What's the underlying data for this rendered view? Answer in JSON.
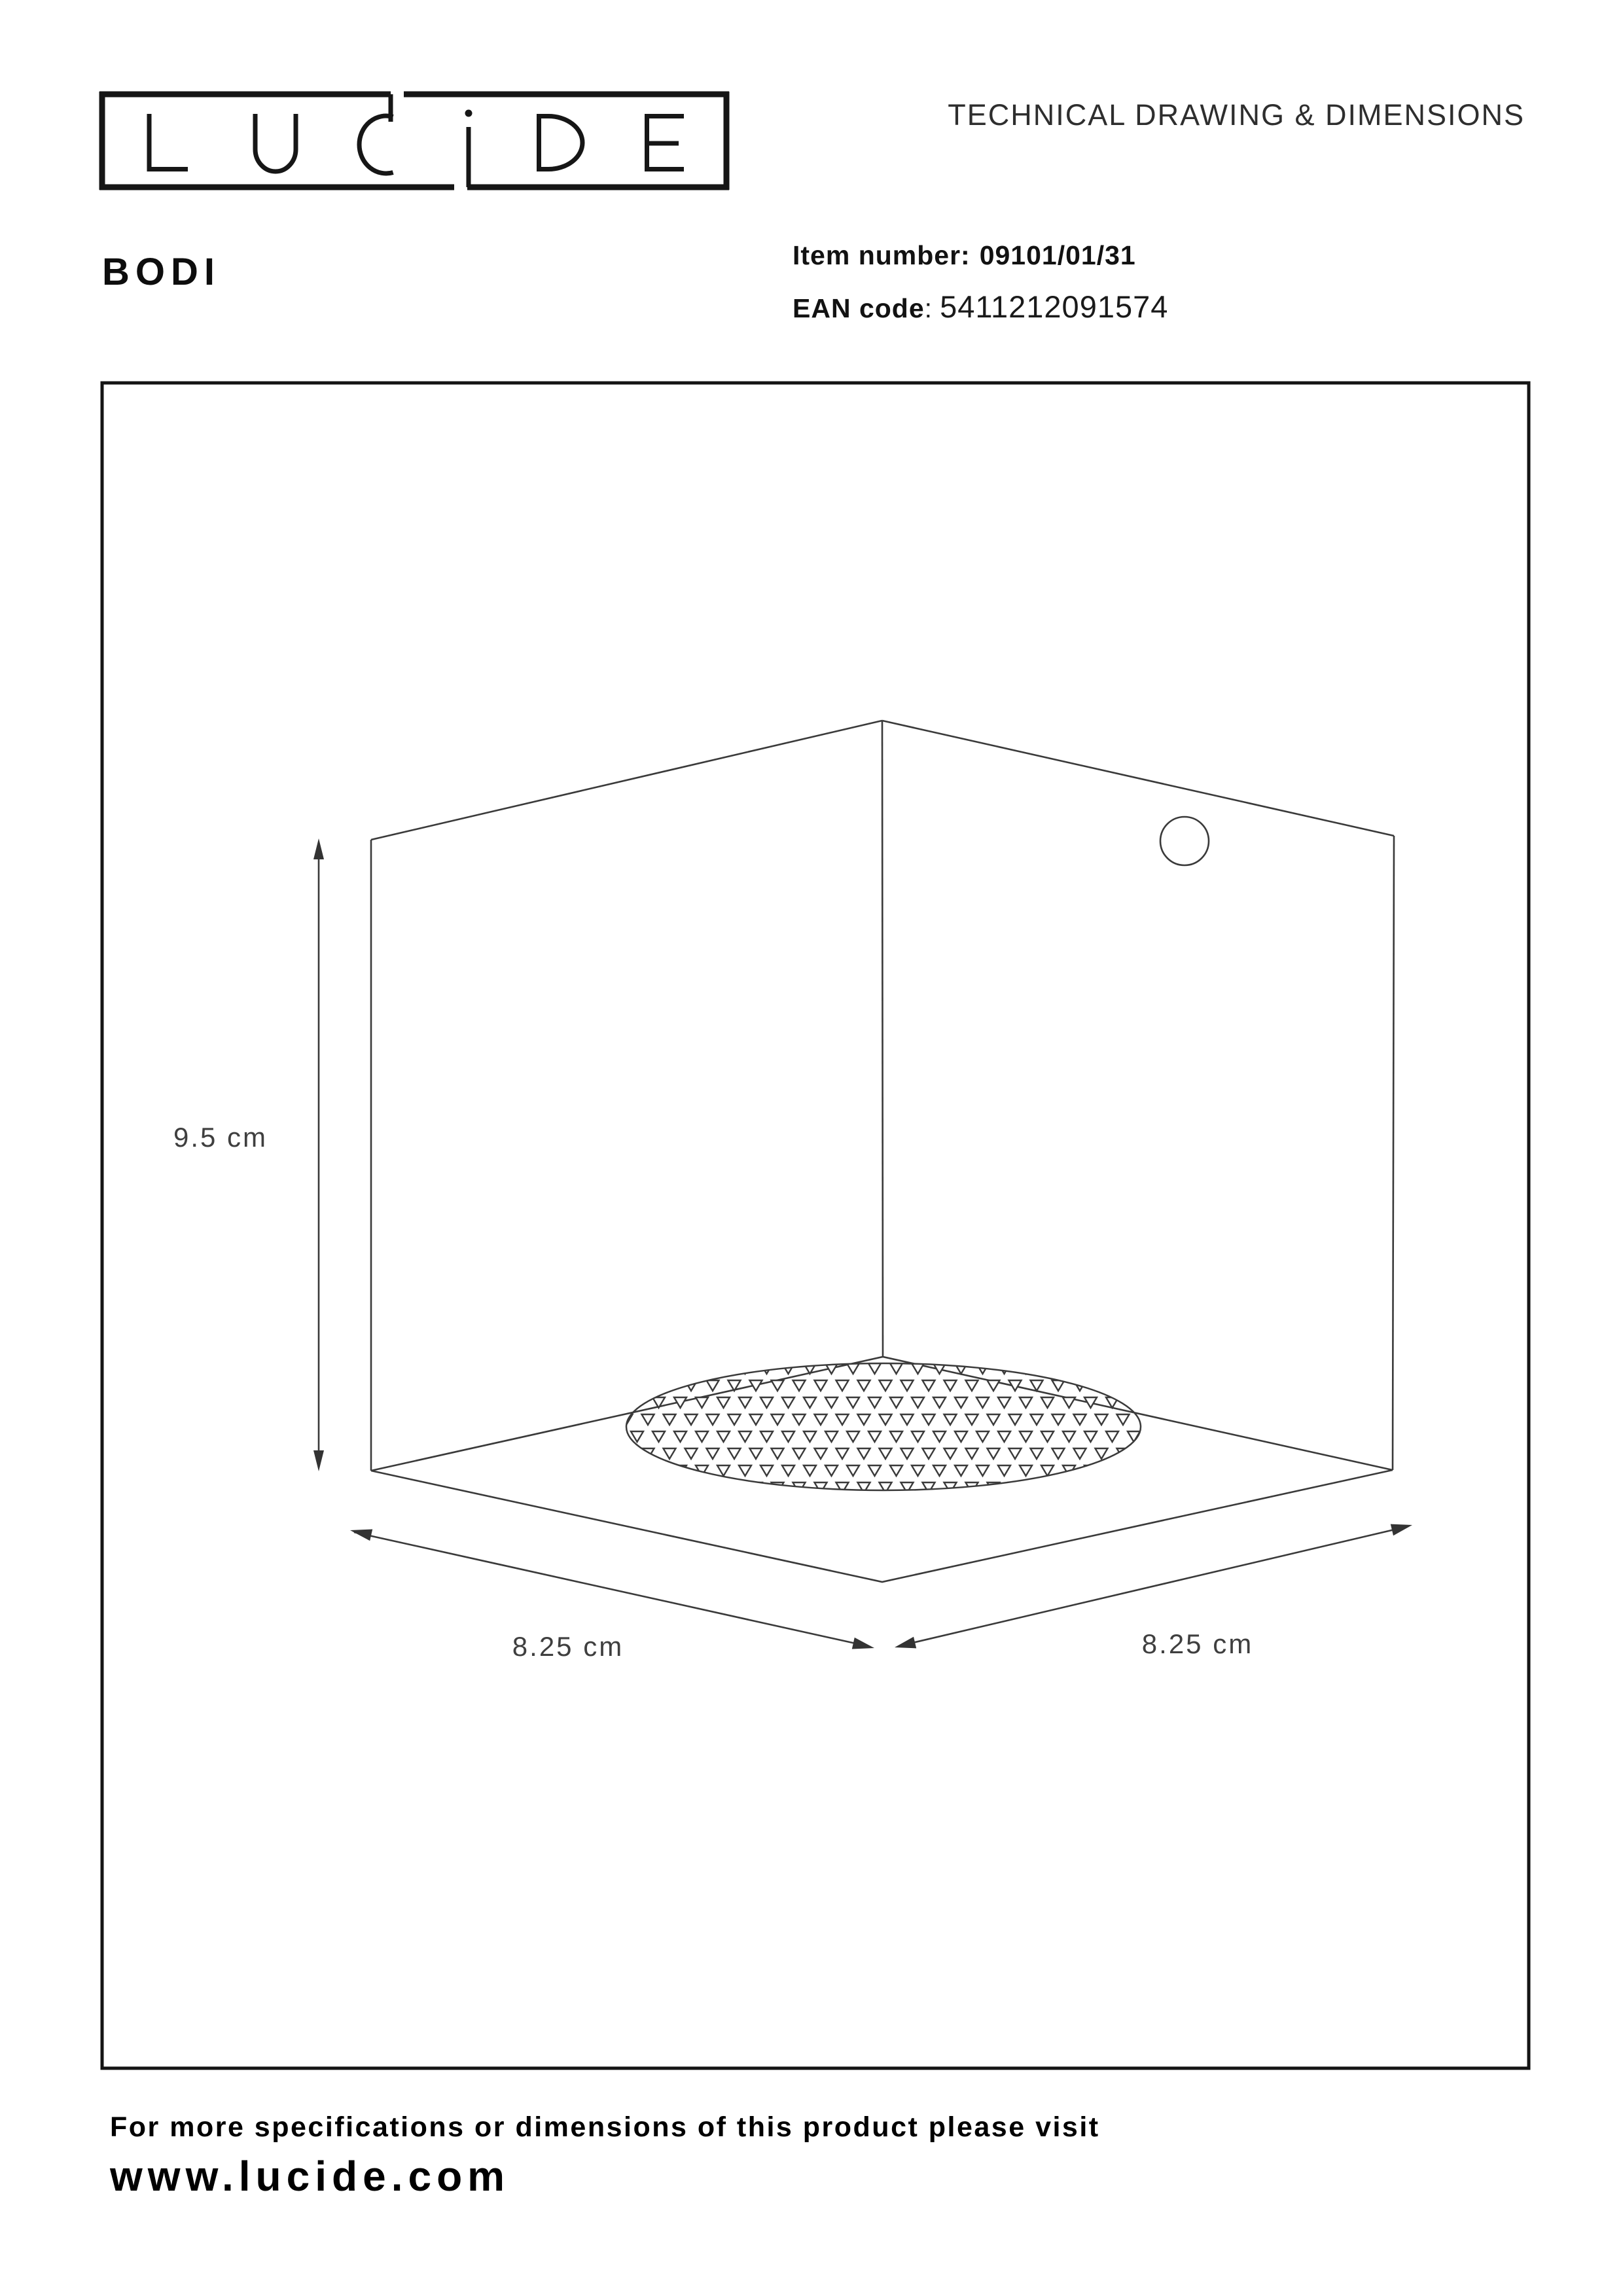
{
  "header": {
    "logo_text": "LUCIDE",
    "doc_title": "TECHNICAL DRAWING & DIMENSIONS",
    "product_name": "BODI",
    "item_label": "Item number:",
    "item_value": "09101/01/31",
    "ean_label": "EAN code",
    "ean_colon": ":",
    "ean_value": "5411212091574"
  },
  "drawing": {
    "height_label": "9.5 cm",
    "width_left_label": "8.25 cm",
    "width_right_label": "8.25 cm"
  },
  "footer": {
    "line1": "For more specifications or dimensions of this product please visit",
    "line2": "www.lucide.com"
  },
  "colors": {
    "ink": "#111111",
    "line": "#3a3a3a",
    "label": "#3f3f3f"
  }
}
